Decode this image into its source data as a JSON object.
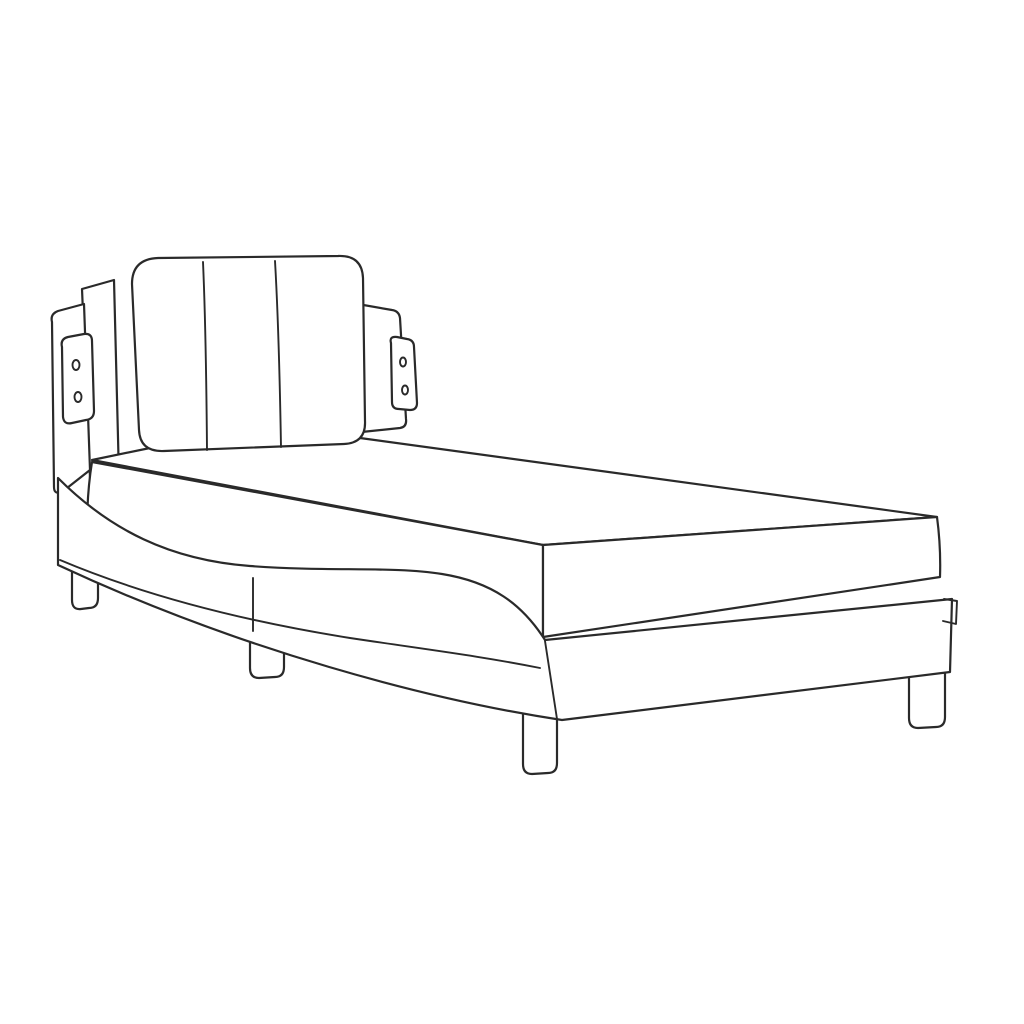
{
  "figure": {
    "kind": "product dimension diagram",
    "subject": "bed frame with headboard and mattress, line art"
  },
  "colors": {
    "accent": "#9a1689",
    "ink": "#2a2a2a",
    "background": "#ffffff"
  },
  "diagram": {
    "dimensions": [
      {
        "id": "headboard-width",
        "label": "90 cm (35.4”)",
        "from": [
          72,
          242
        ],
        "to": [
          383,
          242
        ],
        "label_pos": [
          227,
          213
        ],
        "label_rot": 0
      },
      {
        "id": "headboard-height",
        "label": "48 cm (18.9”)",
        "from": [
          411,
          259
        ],
        "to": [
          446,
          448
        ],
        "label_pos": [
          454,
          352
        ],
        "label_rot": 80
      },
      {
        "id": "overall-height",
        "label": "74,5 cm (29.3”)",
        "from": [
          43,
          284
        ],
        "to": [
          43,
          606
        ],
        "label_pos": [
          22,
          487
        ],
        "label_rot": -90
      },
      {
        "id": "mattress-thickness",
        "label": "13 cm (5.1”)",
        "from": [
          93,
          473
        ],
        "to": [
          143,
          473
        ],
        "label_pos": [
          124,
          501
        ],
        "label_rot": 0
      },
      {
        "id": "mattress-length",
        "label": "190 cm (74.8”)",
        "from": [
          291,
          428
        ],
        "to": [
          838,
          525
        ],
        "label_pos": [
          633,
          466
        ],
        "label_rot": 10
      },
      {
        "id": "mattress-width",
        "label": "90 cm (35.4”)",
        "from": [
          548,
          594
        ],
        "to": [
          940,
          559
        ],
        "label_pos": [
          757,
          592
        ],
        "label_rot": -5.2
      },
      {
        "id": "frame-foot-height",
        "label": "23 cm (9.1”)",
        "from": [
          972,
          603
        ],
        "to": [
          972,
          722
        ],
        "label_pos": [
          1000,
          660
        ],
        "label_rot": 90
      },
      {
        "id": "frame-mid-height",
        "label": "30 cm (11.8”)",
        "from": [
          353,
          548
        ],
        "to": [
          353,
          690
        ],
        "label_pos": [
          322,
          620
        ],
        "label_rot": -90
      },
      {
        "id": "overall-length",
        "label": "208 cm (81.9”)",
        "from": [
          62,
          625
        ],
        "to": [
          540,
          792
        ],
        "label_pos": [
          291,
          726
        ],
        "label_rot": 19.3
      },
      {
        "id": "leg-height",
        "label": "9,5 cm (3.7”)",
        "from": [
          538,
          718
        ],
        "to": [
          538,
          771
        ],
        "label_pos": [
          508,
          701
        ],
        "label_rot": -90
      },
      {
        "id": "base-width",
        "label": "95 cm (37.4”)",
        "from": [
          540,
          794
        ],
        "to": [
          950,
          747
        ],
        "label_pos": [
          736,
          790
        ],
        "label_rot": -6.6
      }
    ]
  }
}
